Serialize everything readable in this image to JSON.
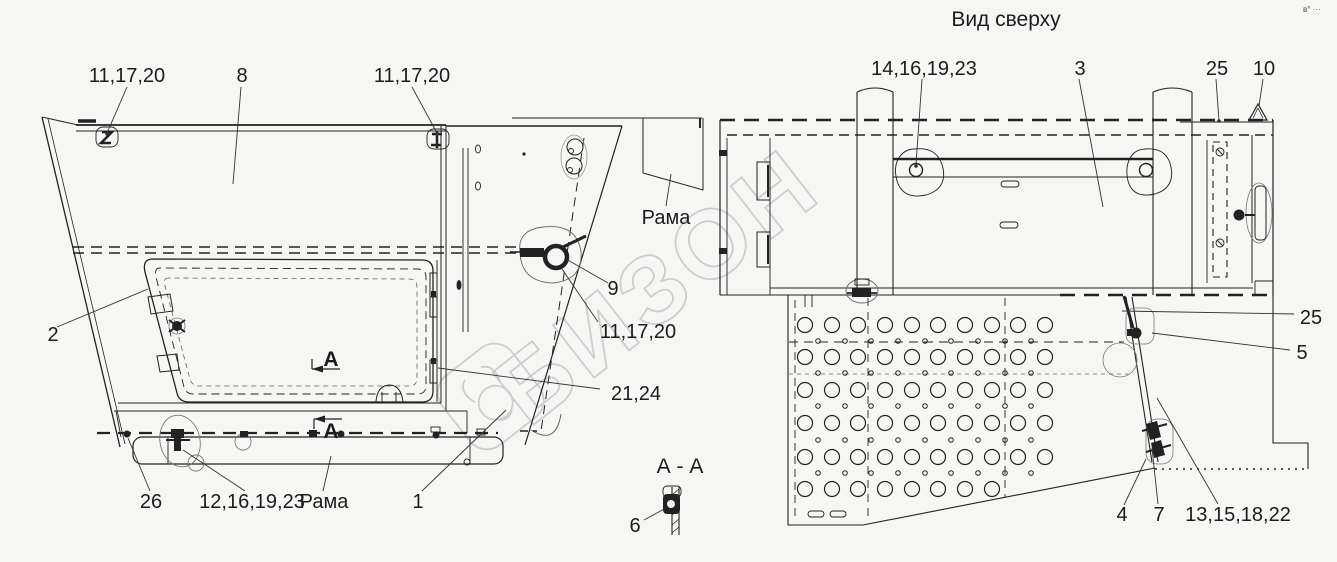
{
  "page": {
    "background": "#f6f6f4",
    "line_color": "#222222",
    "watermark_color": "#cdcdcd"
  },
  "corner_mark": "в° ···",
  "watermark": {
    "text": "БИЗОН"
  },
  "side_view": {
    "callouts": {
      "c11a": "11,17,20",
      "c8": "8",
      "c11b": "11,17,20",
      "c2": "2",
      "c9": "9",
      "c11c": "11,17,20",
      "c21": "21,24",
      "c26": "26",
      "c12": "12,16,19,23",
      "frame_bottom": "Рама",
      "c1": "1",
      "frame_right": "Рама",
      "sec_a1": "А",
      "sec_a2": "А"
    }
  },
  "top_view": {
    "title": "Вид сверху",
    "callouts": {
      "c14": "14,16,19,23",
      "c3": "3",
      "c25a": "25",
      "c10": "10",
      "c25b": "25",
      "c5": "5",
      "c4": "4",
      "c7": "7",
      "c13": "13,15,18,22"
    }
  },
  "section_view": {
    "title": "А - А",
    "c6": "6"
  }
}
